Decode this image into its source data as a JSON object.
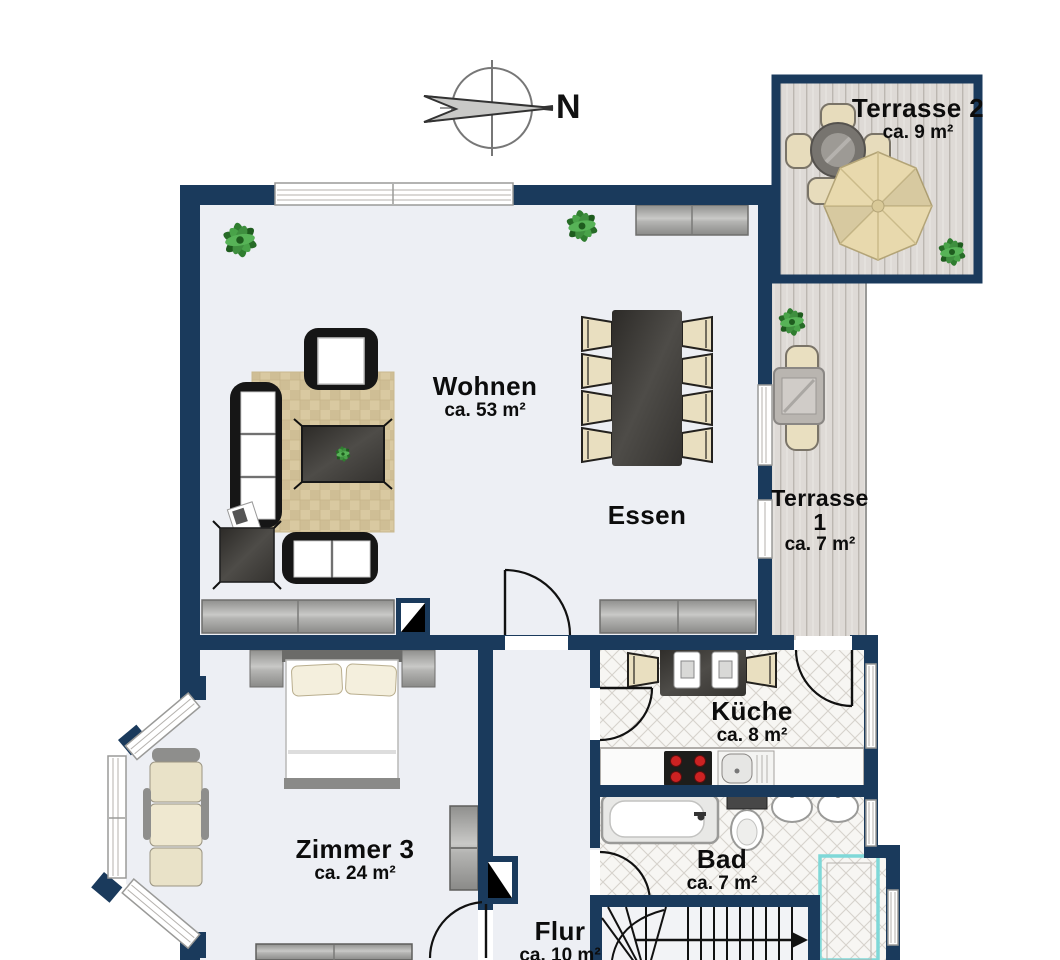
{
  "compass": {
    "label": "N"
  },
  "rooms": {
    "terrasse2": {
      "name": "Terrasse 2",
      "area": "ca. 9 m²"
    },
    "wohnen": {
      "name": "Wohnen",
      "area": "ca. 53 m²"
    },
    "essen": {
      "name": "Essen"
    },
    "terrasse1": {
      "name": "Terrasse",
      "line2": "1",
      "area": "ca. 7 m²"
    },
    "kueche": {
      "name": "Küche",
      "area": "ca. 8 m²"
    },
    "bad": {
      "name": "Bad",
      "area": "ca. 7 m²"
    },
    "zimmer3": {
      "name": "Zimmer 3",
      "area": "ca. 24 m²"
    },
    "flur": {
      "name": "Flur",
      "area": "ca. 10 m²"
    }
  },
  "colors": {
    "wall": "#1a3a5c",
    "floor": "#edeff4",
    "deck": "#dedad6",
    "deck_line": "#bcb7b1",
    "tile": "#f7f6f3",
    "tile_line": "#d6d2cc",
    "rug": "#d9c9a1",
    "shower_border": "#7fd8d8",
    "stove_burner": "#cc2222",
    "plant": "#2f7d2f",
    "chair": "#e9dfc0",
    "furniture_dark": "#35332f",
    "sofa_frame": "#161616",
    "parasol": "#e8d9ad"
  }
}
